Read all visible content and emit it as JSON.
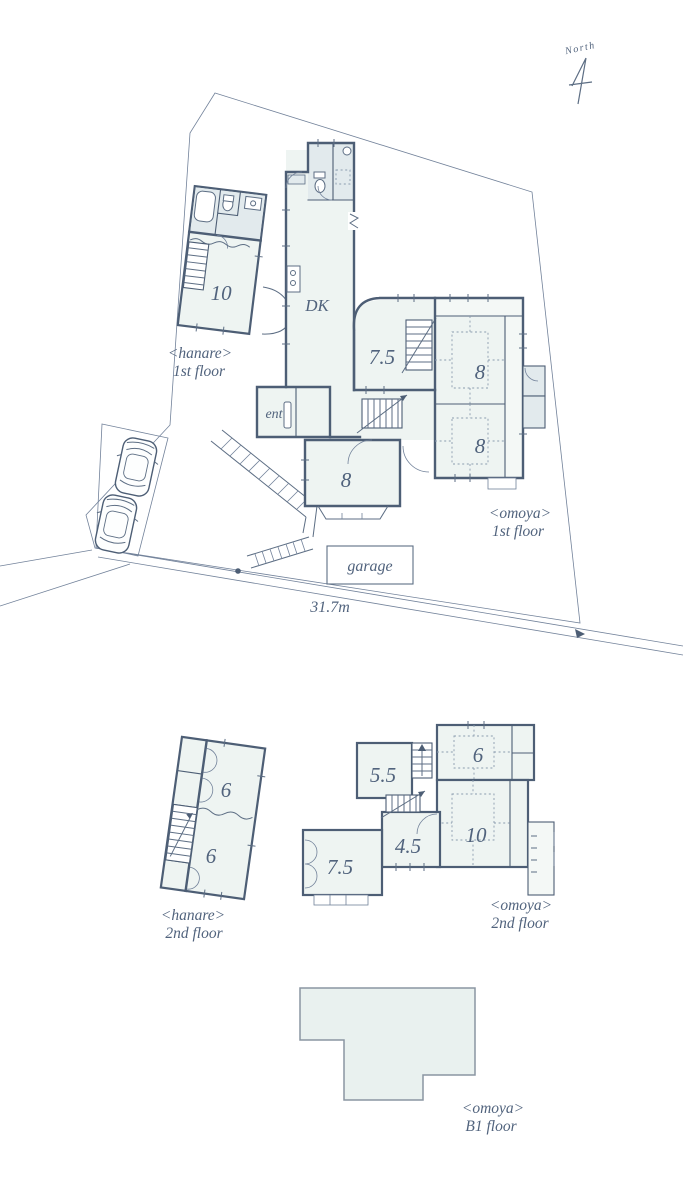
{
  "meta": {
    "kind": "site-and-floor-plan",
    "width": 683,
    "height": 1200
  },
  "colors": {
    "background": "#ffffff",
    "wall": "#4d5e75",
    "thin_line": "#72829a",
    "room_fill": "#eef4f2",
    "engawa_fill": "#f4f8f6",
    "fixture_fill": "#e2eaed",
    "tatami_dotted": "#8b9cae",
    "b1_fill": "#e9f1ef",
    "b1_stroke": "#8a95a2",
    "text": "#51637d"
  },
  "north": {
    "label": "North"
  },
  "site": {
    "road_dimension": "31.7m",
    "garage_label": "garage"
  },
  "hanare_1f": {
    "name": "<hanare>",
    "floor": "1st floor",
    "room_10": "10"
  },
  "omoya_1f": {
    "name": "<omoya>",
    "floor": "1st floor",
    "dk": "DK",
    "entrance": "ent",
    "room_7_5": "7.5",
    "room_8_ne": "8",
    "room_8_se": "8",
    "room_8_s": "8"
  },
  "hanare_2f": {
    "name": "<hanare>",
    "floor": "2nd floor",
    "room_6_n": "6",
    "room_6_s": "6"
  },
  "omoya_2f": {
    "name": "<omoya>",
    "floor": "2nd floor",
    "room_5_5": "5.5",
    "room_6": "6",
    "room_4_5": "4.5",
    "room_10": "10",
    "room_7_5": "7.5"
  },
  "omoya_b1": {
    "name": "<omoya>",
    "floor": "B1 floor"
  }
}
